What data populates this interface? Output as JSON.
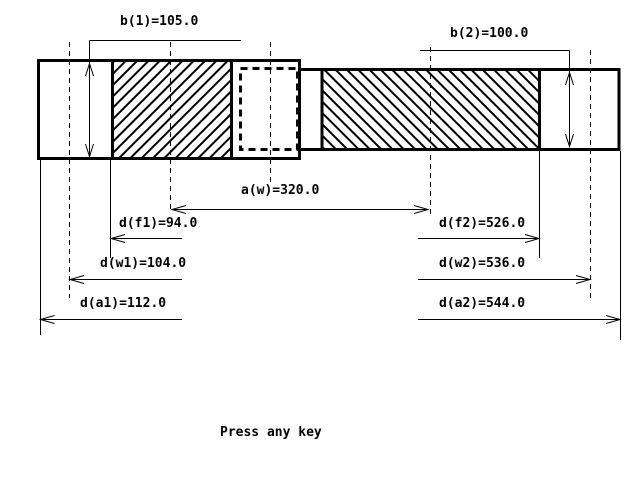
{
  "screen": {
    "background": "#ffffff",
    "ink": "#000000",
    "prompt": "Press any key"
  },
  "dimensions": {
    "b1": {
      "label": "b(1)=105.0",
      "name": "b(1)",
      "value": 105.0
    },
    "b2": {
      "label": "b(2)=100.0",
      "name": "b(2)",
      "value": 100.0
    },
    "aw": {
      "label": "a(w)=320.0",
      "name": "a(w)",
      "value": 320.0
    },
    "df1": {
      "label": "d(f1)=94.0",
      "name": "d(f1)",
      "value": 94.0
    },
    "dw1": {
      "label": "d(w1)=104.0",
      "name": "d(w1)",
      "value": 104.0
    },
    "da1": {
      "label": "d(a1)=112.0",
      "name": "d(a1)",
      "value": 112.0
    },
    "df2": {
      "label": "d(f2)=526.0",
      "name": "d(f2)",
      "value": 526.0
    },
    "dw2": {
      "label": "d(w2)=536.0",
      "name": "d(w2)",
      "value": 536.0
    },
    "da2": {
      "label": "d(a2)=544.0",
      "name": "d(a2)",
      "value": 544.0
    }
  }
}
